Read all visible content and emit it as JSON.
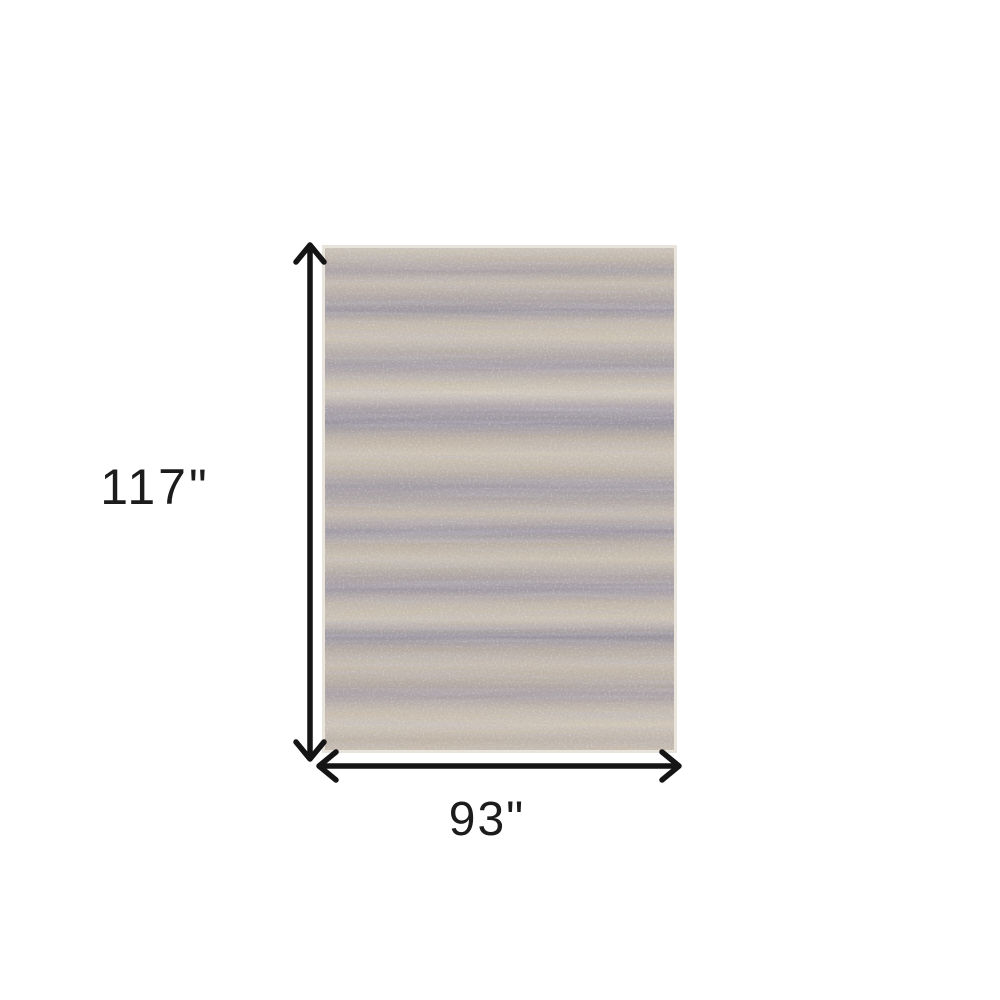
{
  "canvas": {
    "width": 1000,
    "height": 1000,
    "background": "#ffffff"
  },
  "diagram": {
    "kind": "product-dimensions",
    "product": "heathered area rug with horizontal beige, tan and gray-lavender striations",
    "height_label": "117\"",
    "width_label": "93\"",
    "arrow_color": "#151515",
    "label_color": "#1c1c1c",
    "rug_colors": {
      "edge": "#e9e4db",
      "base_beige": "#c6bbad",
      "cream_highlight": "#d5ccbe",
      "gray_lavender_streak": "#9a95a0",
      "dark_grain": "#5f5a62"
    }
  }
}
